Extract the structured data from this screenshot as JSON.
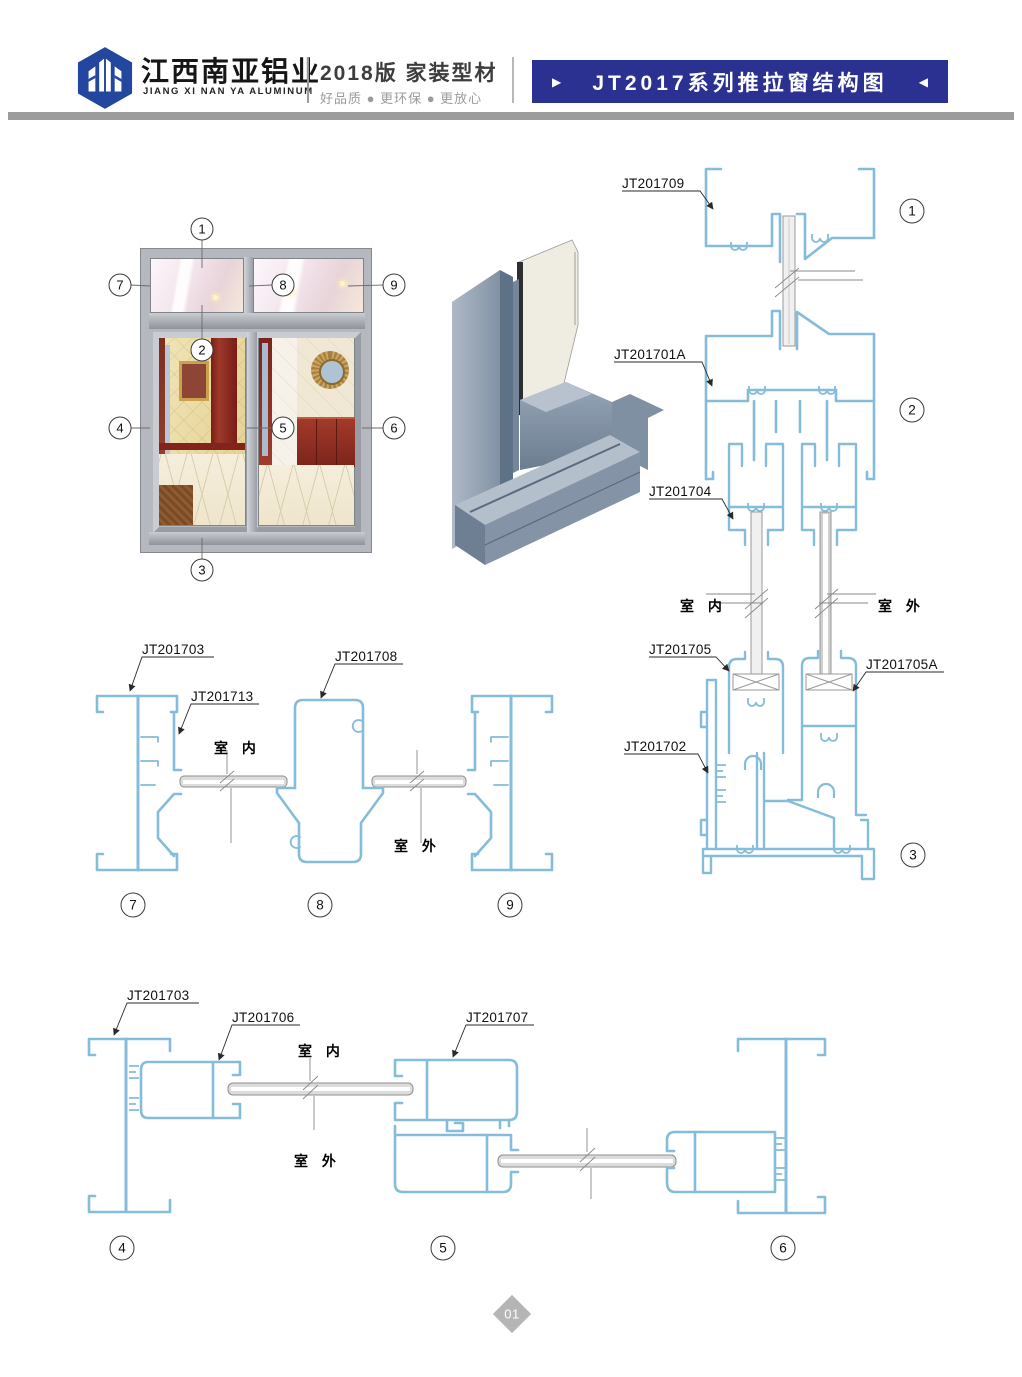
{
  "header": {
    "brand_cn": "江西南亚铝业",
    "brand_en": "JIANG XI NAN YA ALUMINUM",
    "edition": "2018版  家装型材",
    "slogan": "好品质 ● 更环保 ● 更放心",
    "banner_title": "JT2017系列推拉窗结构图",
    "banner_left_arrow": "▶",
    "banner_right_arrow": "◀",
    "banner_color": "#2b3191"
  },
  "colors": {
    "profile_line": "#84bcda",
    "glass_fill": "#ededed",
    "accent_blue": "#2b3191",
    "frame_gray": "#b5b9bf"
  },
  "photo_callouts": {
    "c1": "1",
    "c2": "2",
    "c3": "3",
    "c4": "4",
    "c5": "5",
    "c6": "6",
    "c7": "7",
    "c8": "8",
    "c9": "9"
  },
  "vertical_section": {
    "label_jt201709": "JT201709",
    "label_jt201701a": "JT201701A",
    "label_jt201704": "JT201704",
    "label_jt201705": "JT201705",
    "label_jt201705a": "JT201705A",
    "label_jt201702": "JT201702",
    "indoor": "室 内",
    "outdoor": "室 外",
    "marker1": "1",
    "marker2": "2",
    "marker3": "3"
  },
  "horizontal_section_mid": {
    "label_jt201703": "JT201703",
    "label_jt201713": "JT201713",
    "label_jt201708": "JT201708",
    "indoor": "室 内",
    "outdoor": "室 外",
    "marker7": "7",
    "marker8": "8",
    "marker9": "9"
  },
  "horizontal_section_bottom": {
    "label_jt201703": "JT201703",
    "label_jt201706": "JT201706",
    "label_jt201707": "JT201707",
    "indoor": "室 内",
    "outdoor": "室 外",
    "marker4": "4",
    "marker5": "5",
    "marker6": "6"
  },
  "footer": {
    "page_number": "01"
  }
}
